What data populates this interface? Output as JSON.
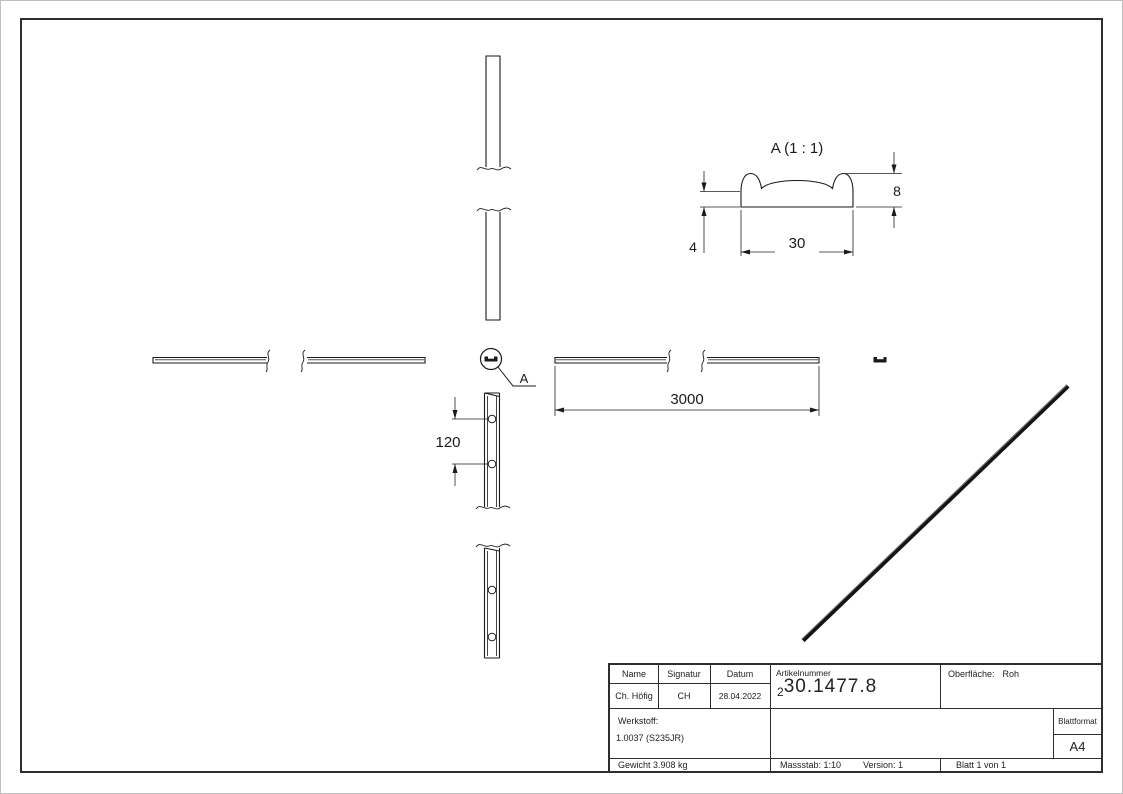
{
  "sheet": {
    "background": "#ffffff",
    "frame_color": "#2e2e2e",
    "line_color": "#1a1a1a"
  },
  "views": {
    "detail_view": {
      "title": "A (1 : 1)",
      "dim_profile_width": "30",
      "dim_profile_height": "8",
      "dim_profile_base_height": "4"
    },
    "plan_view": {
      "dim_length": "3000"
    },
    "side_view": {
      "dim_hole_spacing": "120"
    },
    "detail_callout": {
      "label": "A"
    }
  },
  "title_block": {
    "name_header": "Name",
    "signatur_header": "Signatur",
    "datum_header": "Datum",
    "name_value": "Ch. Höfig",
    "signatur_value": "CH",
    "datum_value": "28.04.2022",
    "artikelnummer_label": "Artikelnummer",
    "artikelnummer_prefix": "2",
    "artikelnummer_value": "30.1477.8",
    "oberflaeche_label": "Oberfläche:",
    "oberflaeche_value": "Roh",
    "werkstoff_label": "Werkstoff:",
    "werkstoff_value": "1.0037 (S235JR)",
    "blattformat_label": "Blattformat",
    "blattformat_value": "A4",
    "gewicht": "Gewicht 3.908 kg",
    "massstab": "Massstab: 1:10",
    "version": "Version: 1",
    "blatt": "Blatt 1 von 1"
  }
}
